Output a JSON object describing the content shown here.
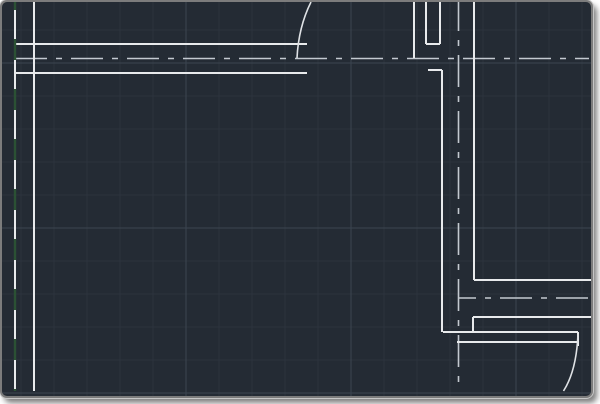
{
  "window": {
    "width": 600,
    "height": 404,
    "background": "#242b34",
    "frame_border_color": "#7c7c7c",
    "frame_outline_color": "#c6c6c6"
  },
  "grid": {
    "offset_x": 21,
    "offset_y": 30,
    "spacing": 33,
    "minor_color": "#2c333d",
    "major_color": "#3b4450",
    "minor_width": 1,
    "major_width": 1,
    "major_x": [
      186,
      351,
      516
    ],
    "major_y": [
      63,
      228,
      393
    ]
  },
  "layers": {
    "walls": {
      "name": "wall-lines",
      "color": "#e8eaec",
      "width": 2,
      "segments": [
        [
          15,
          2,
          15,
          391
        ],
        [
          34,
          2,
          34,
          391
        ],
        [
          15,
          44,
          307,
          44
        ],
        [
          15,
          73,
          307,
          73
        ],
        [
          414,
          2,
          414,
          58
        ],
        [
          426,
          2,
          426,
          44
        ],
        [
          440,
          2,
          440,
          44
        ],
        [
          426,
          44,
          440,
          44
        ],
        [
          428,
          70,
          442,
          70
        ],
        [
          442,
          70,
          442,
          332
        ],
        [
          474,
          2,
          474,
          280
        ],
        [
          474,
          280,
          591,
          280
        ],
        [
          473,
          317,
          591,
          317
        ],
        [
          473,
          317,
          473,
          332
        ],
        [
          443,
          332,
          578,
          332
        ],
        [
          457,
          342,
          578,
          342
        ],
        [
          578,
          332,
          578,
          346
        ]
      ]
    },
    "centerlines": {
      "name": "centerline-axes",
      "color": "#c3c9d0",
      "width": 1.6,
      "dash": "32 9 6 9",
      "segments": [
        {
          "x1": 15,
          "y1": 58.5,
          "x2": 589,
          "y2": 58.5,
          "dashoffset": 0
        },
        {
          "x1": 458.5,
          "y1": 2,
          "x2": 458.5,
          "y2": 391,
          "dashoffset": 3
        },
        {
          "x1": 458,
          "y1": 298,
          "x2": 589,
          "y2": 298,
          "dashoffset": 14
        }
      ]
    },
    "green_axis": {
      "name": "green-dashed-axis",
      "color": "#2b5134",
      "width": 2.4,
      "dash": "21 29",
      "dashoffset": 13,
      "segments": [
        [
          15,
          2,
          15,
          391
        ]
      ]
    },
    "door_arcs": {
      "name": "door-swing-arcs",
      "color": "#dfe2e5",
      "width": 1.6,
      "paths": [
        "M297,58 C298,38 303,18 311,2",
        "M578,334 C577,358 572.5,377 563.5,391"
      ]
    }
  }
}
